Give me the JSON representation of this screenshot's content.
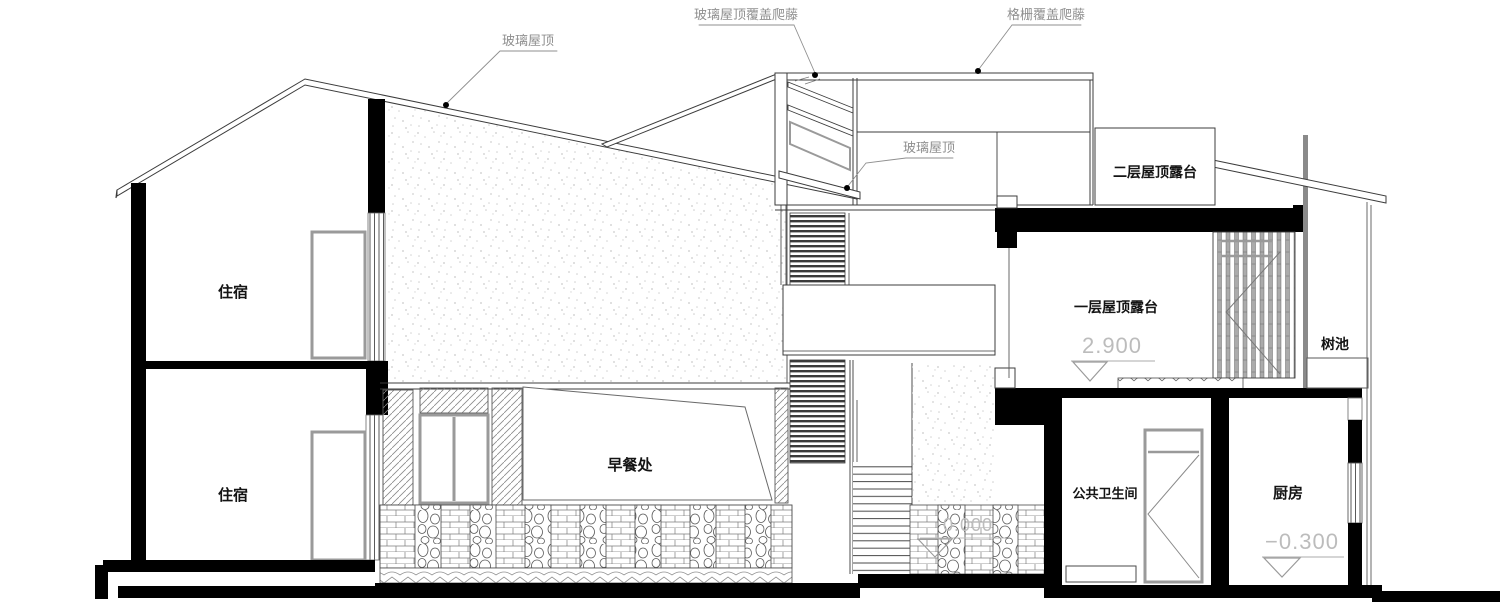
{
  "annotations": {
    "glass_roof_left": "玻璃屋顶",
    "glass_roof_vines": "玻璃屋顶覆盖爬藤",
    "grille_vines": "格栅覆盖爬藤",
    "glass_roof_mid": "玻璃屋顶"
  },
  "rooms": {
    "accommodation_upper": "住宿",
    "accommodation_lower": "住宿",
    "breakfast_area": "早餐处",
    "public_restroom": "公共卫生间",
    "kitchen": "厨房",
    "roof_terrace_l2": "二层屋顶露台",
    "roof_terrace_l1": "一层屋顶露台",
    "tree_pit": "树池"
  },
  "elevations": {
    "terrace_l1": "2.900",
    "ground": "0.000",
    "kitchen": "−0.300"
  },
  "colors": {
    "line": "#3c3c3c",
    "cut_fill": "#000000",
    "annotation_gray": "#8f8f8f",
    "elevation_gray": "#bcbcbc",
    "louver_gray": "#a8a8a8"
  }
}
